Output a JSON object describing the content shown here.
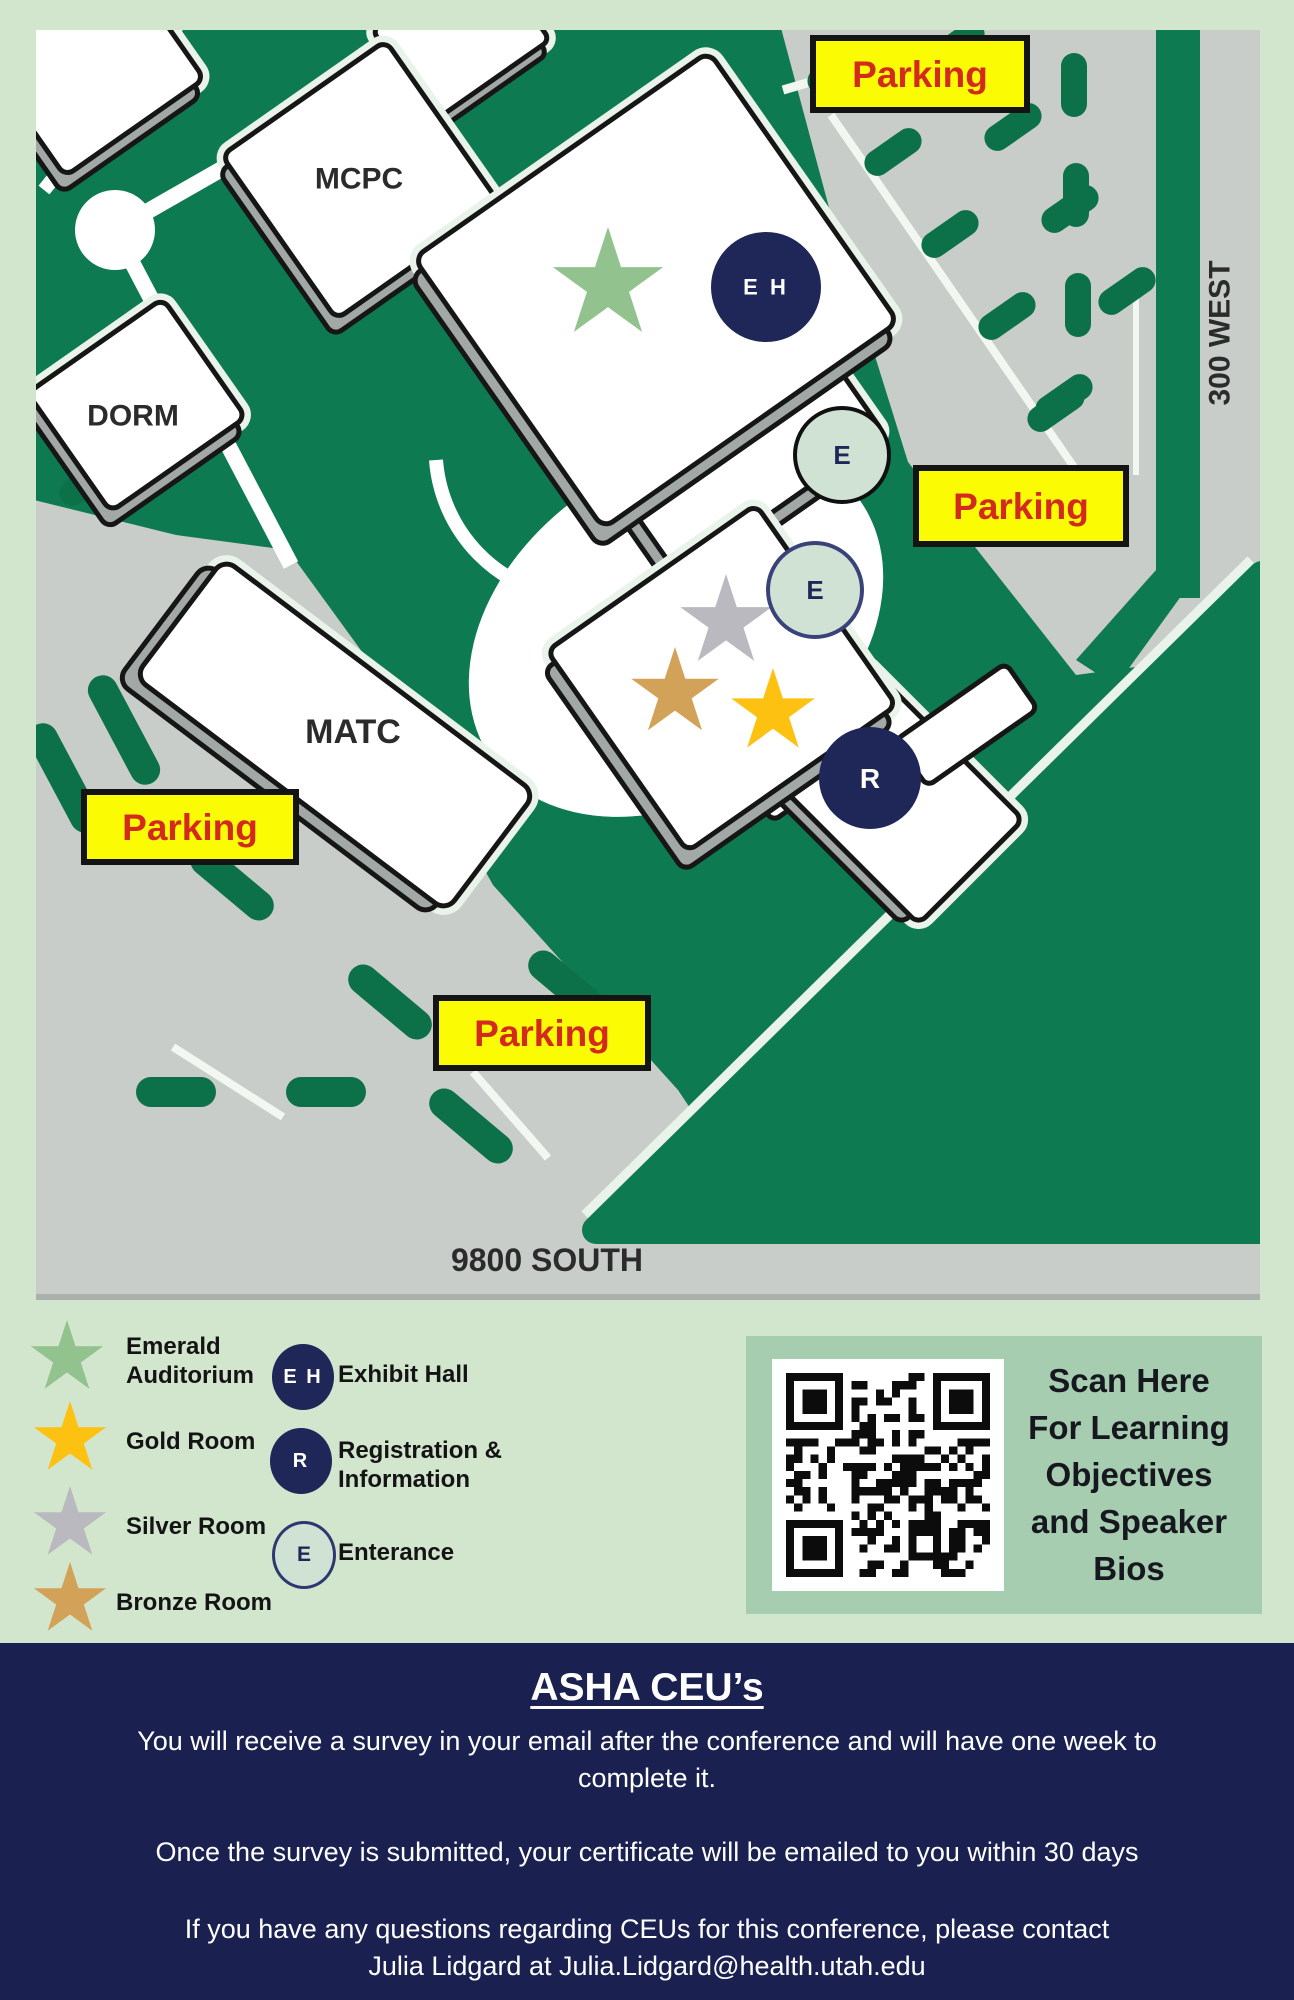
{
  "colors": {
    "page_bg": "#d2e5cd",
    "map_green": "#0e7a52",
    "dash_green": "#0c7149",
    "road_gray": "#c9cdca",
    "building_white": "#ffffff",
    "outline_black": "#161616",
    "shadow_gray": "#a2a8a6",
    "sign_yellow": "#fbfb04",
    "sign_red": "#d42a1e",
    "navy": "#1e2758",
    "footer_navy": "#1a2150",
    "entrance_fill": "#cfe2d4",
    "qr_card_green": "#a6cdb0",
    "emerald": "#92c28d",
    "gold": "#fdc112",
    "silver": "#b9b9bf",
    "bronze": "#d2a258"
  },
  "map": {
    "buildings": {
      "mcpc": "MCPC",
      "dorm": "DORM",
      "matc": "MATC"
    },
    "streets": {
      "south": "9800 SOUTH",
      "west": "300 WEST"
    },
    "parking_label": "Parking",
    "markers": {
      "exhibit_hall": "E H",
      "entrance": "E",
      "registration": "R"
    }
  },
  "legend": {
    "rooms": [
      {
        "id": "emerald-auditorium",
        "label": "Emerald Auditorium",
        "color": "#92c28d"
      },
      {
        "id": "gold-room",
        "label": "Gold Room",
        "color": "#fdc112"
      },
      {
        "id": "silver-room",
        "label": "Silver Room",
        "color": "#b9b9bf"
      },
      {
        "id": "bronze-room",
        "label": "Bronze Room",
        "color": "#d2a258"
      }
    ],
    "points": [
      {
        "id": "exhibit-hall",
        "symbol": "E H",
        "label": "Exhibit Hall"
      },
      {
        "id": "registration",
        "symbol": "R",
        "label": "Registration & Information"
      },
      {
        "id": "entrance",
        "symbol": "E",
        "label": "Enterance"
      }
    ]
  },
  "qr": {
    "lines": [
      "Scan Here",
      "For Learning",
      "Objectives",
      "and Speaker",
      "Bios"
    ]
  },
  "footer": {
    "title": "ASHA CEU’s",
    "p1": [
      "You will receive a survey in your email after the conference and will have one week to",
      "complete it."
    ],
    "p2": "Once the survey is submitted, your certificate will be emailed to you within 30 days",
    "p3": [
      "If you have any questions regarding CEUs for this conference, please contact",
      "Julia Lidgard at Julia.Lidgard@health.utah.edu"
    ]
  }
}
